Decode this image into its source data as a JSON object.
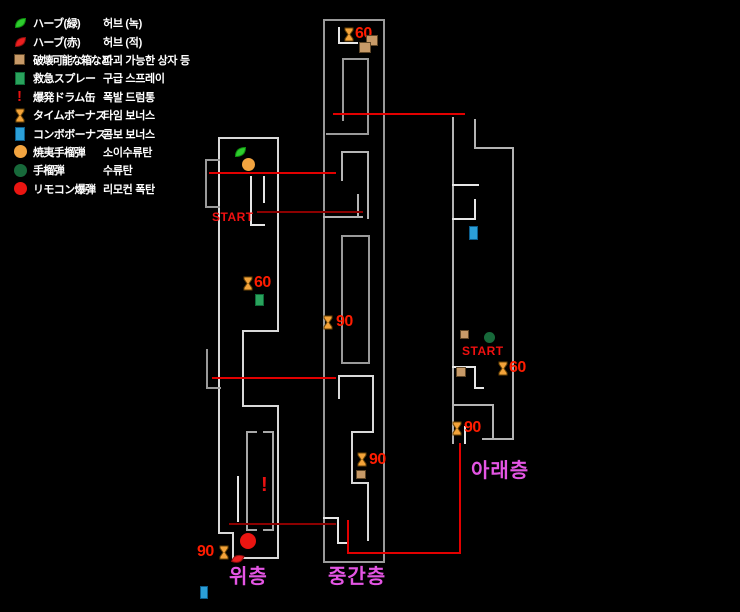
{
  "legend": {
    "items": [
      {
        "icon": "green-herb",
        "jp": "ハーブ(緑)",
        "kr": "허브 (녹)"
      },
      {
        "icon": "red-herb",
        "jp": "ハーブ(赤)",
        "kr": "허브 (적)"
      },
      {
        "icon": "breakable-box",
        "jp": "破壊可能な箱など",
        "kr": "파괴 가능한 상자 등"
      },
      {
        "icon": "first-aid-spray",
        "jp": "救急スプレー",
        "kr": "구급 스프레이"
      },
      {
        "icon": "explosive-drum",
        "jp": "爆発ドラム缶",
        "kr": "폭발 드럼통"
      },
      {
        "icon": "time-bonus",
        "jp": "タイムボーナス",
        "kr": "타임 보너스"
      },
      {
        "icon": "combo-bonus",
        "jp": "コンボボーナス",
        "kr": "콤보 보너스"
      },
      {
        "icon": "incendiary-grenade",
        "jp": "焼夷手榴弾",
        "kr": "소이수류탄"
      },
      {
        "icon": "grenade",
        "jp": "手榴弾",
        "kr": "수류탄"
      },
      {
        "icon": "remote-bomb",
        "jp": "リモコン爆弾",
        "kr": "리모컨 폭탄"
      }
    ]
  },
  "maps": {
    "upper": {
      "label": "위층",
      "start": "START",
      "time_bonus_60": "60",
      "time_bonus_90": "90"
    },
    "middle": {
      "label": "중간층",
      "time_bonus_60": "60",
      "time_bonus_90_a": "90",
      "time_bonus_90_b": "90"
    },
    "lower": {
      "label": "아래층",
      "start": "START",
      "time_bonus_60": "60",
      "time_bonus_90": "90"
    }
  },
  "colors": {
    "background": "#000000",
    "wall": "#9a9a9a",
    "wall_bright": "#dcdcdc",
    "route": "#e20000",
    "route_dark": "#8c0000",
    "floor_label": "#e455e4",
    "marker_number": "#ff1c00",
    "time_bonus": "#f3a33a",
    "breakable_box": "#c79a68",
    "first_aid_spray": "#2aa35d",
    "combo_bonus": "#2b9fd8",
    "incendiary_grenade": "#f2a440",
    "grenade": "#17693a",
    "remote_bomb": "#ea1511"
  }
}
